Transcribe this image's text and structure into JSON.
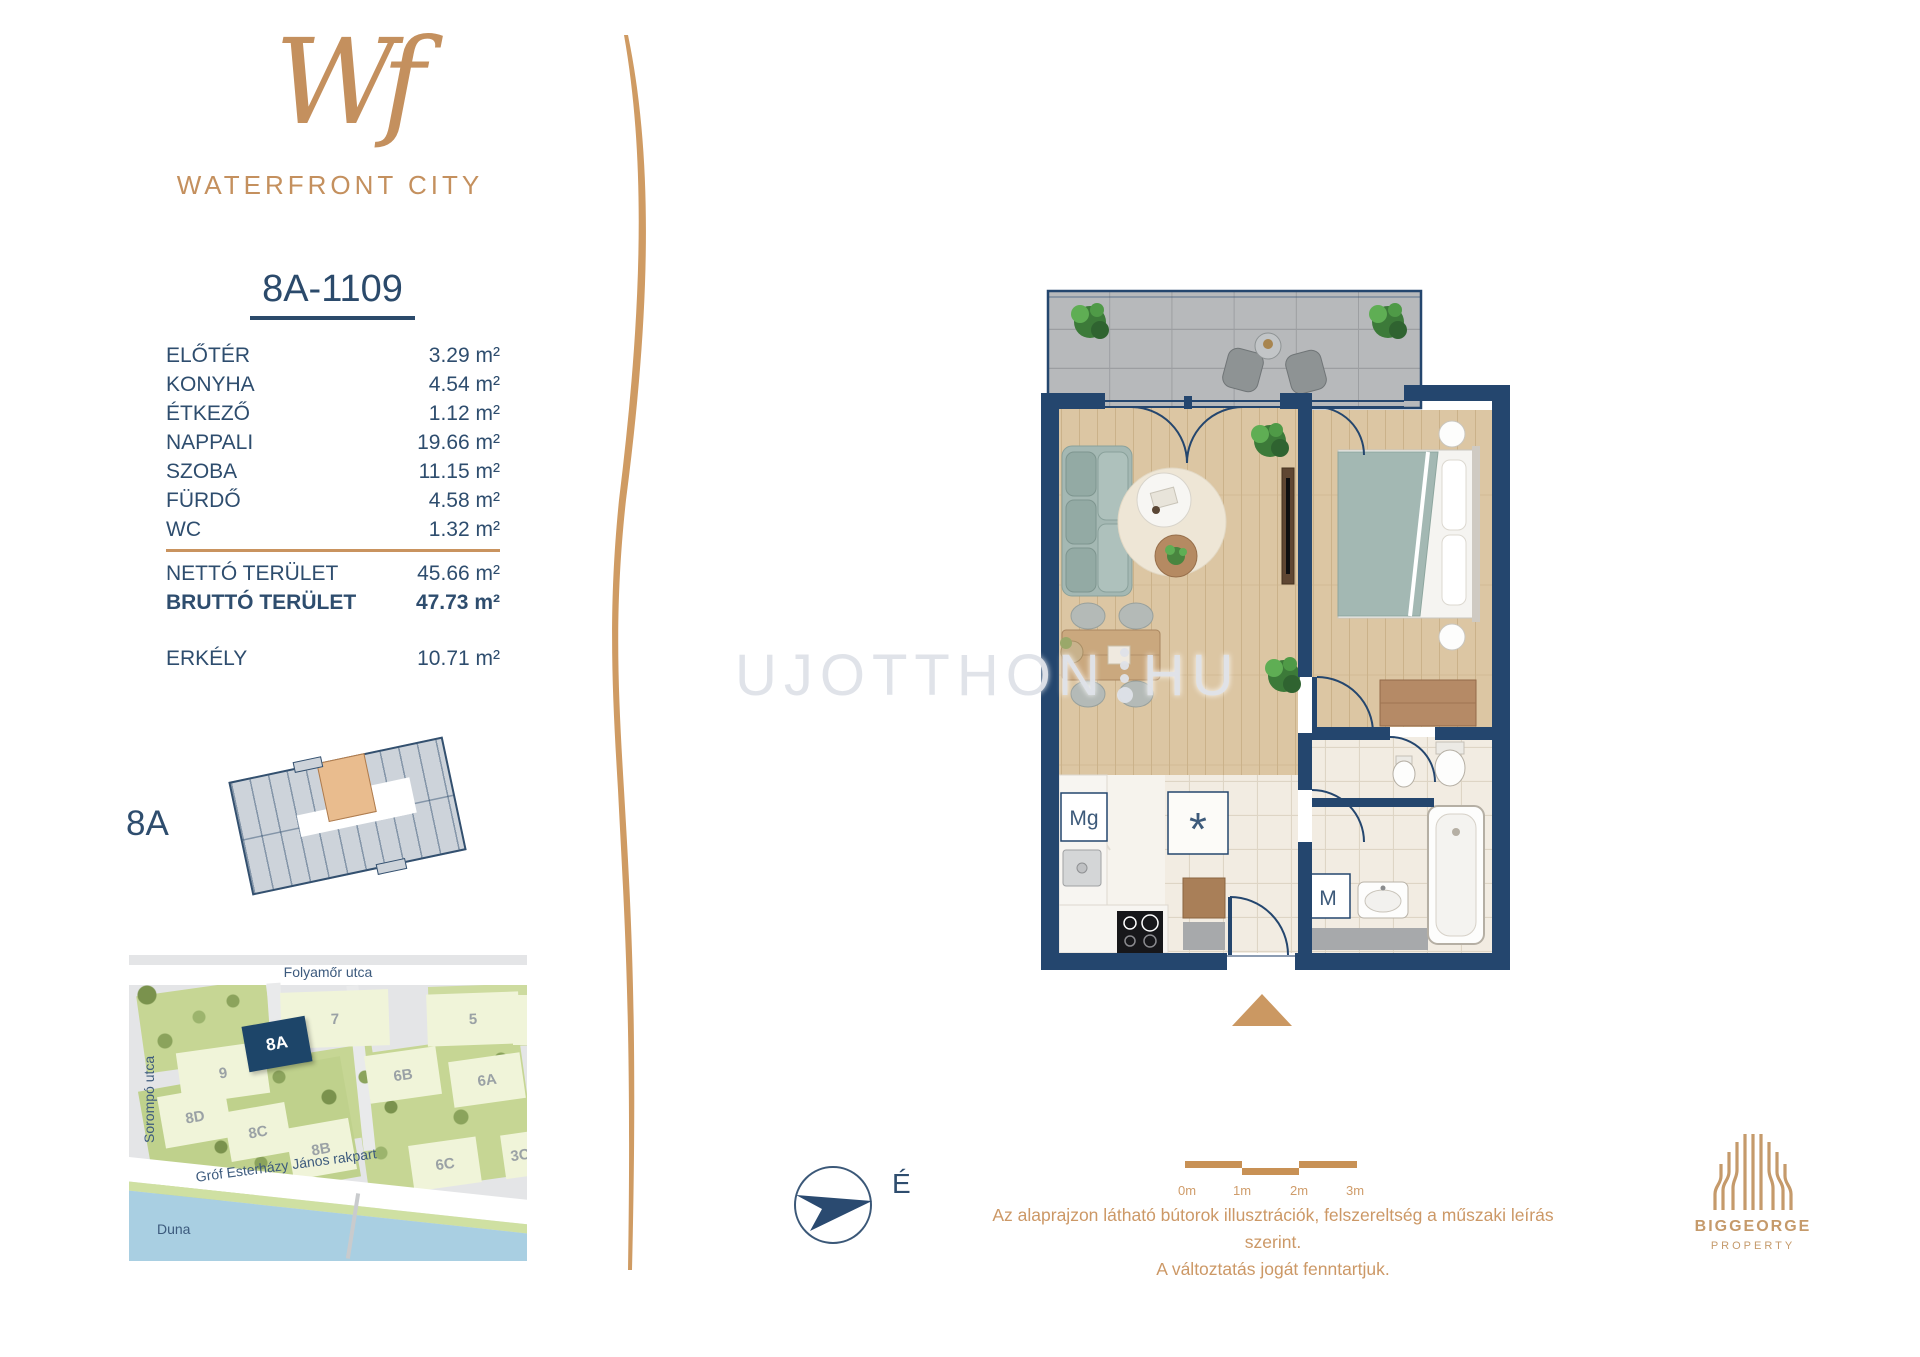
{
  "brand": {
    "monogram": "Wf",
    "name": "WATERFRONT CITY"
  },
  "unit": {
    "id": "8A-1109"
  },
  "rooms": [
    {
      "label": "ELŐTÉR",
      "area": "3.29 m²"
    },
    {
      "label": "KONYHA",
      "area": "4.54 m²"
    },
    {
      "label": "ÉTKEZŐ",
      "area": "1.12 m²"
    },
    {
      "label": "NAPPALI",
      "area": "19.66 m²"
    },
    {
      "label": "SZOBA",
      "area": "11.15 m²"
    },
    {
      "label": "FÜRDŐ",
      "area": "4.58 m²"
    },
    {
      "label": "WC",
      "area": "1.32 m²"
    }
  ],
  "totals": {
    "netto_label": "NETTÓ TERÜLET",
    "netto_area": "45.66 m²",
    "brutto_label": "BRUTTÓ TERÜLET",
    "brutto_area": "47.73 m²",
    "balcony_label": "ERKÉLY",
    "balcony_area": "10.71 m²"
  },
  "building": {
    "label": "8A"
  },
  "map": {
    "street_top": "Folyamőr utca",
    "street_left": "Sorompó utca",
    "street_embankment": "Gróf Esterházy János rakpart",
    "river": "Duna",
    "buildings": [
      "9",
      "7",
      "5",
      "4",
      "8A",
      "6B",
      "6A",
      "8D",
      "8C",
      "8B",
      "6C",
      "3C"
    ]
  },
  "floorplan": {
    "dishwasher_label": "Mg",
    "washer_label": "M",
    "closet_label": "*",
    "north_label": "É"
  },
  "watermark": {
    "left": "UJOTTHON",
    "right": "HU"
  },
  "scalebar": {
    "labels": [
      "0m",
      "1m",
      "2m",
      "3m"
    ]
  },
  "disclaimer": {
    "line1": "Az alaprajzon látható bútorok illusztrációk, felszereltség a műszaki leírás szerint.",
    "line2": "A változtatás jogát fenntartjuk."
  },
  "developer": {
    "name": "BIGGEORGE",
    "subtitle": "PROPERTY"
  },
  "colors": {
    "navy": "#24466e",
    "tan": "#c9935f",
    "wood": "#dcc6a3",
    "balcony_gray": "#b7b9bb",
    "map_water": "#a9cfe2",
    "map_green": "#c6d694",
    "highlight_unit": "#e9bc8e",
    "map_building_navy": "#1d4569"
  }
}
